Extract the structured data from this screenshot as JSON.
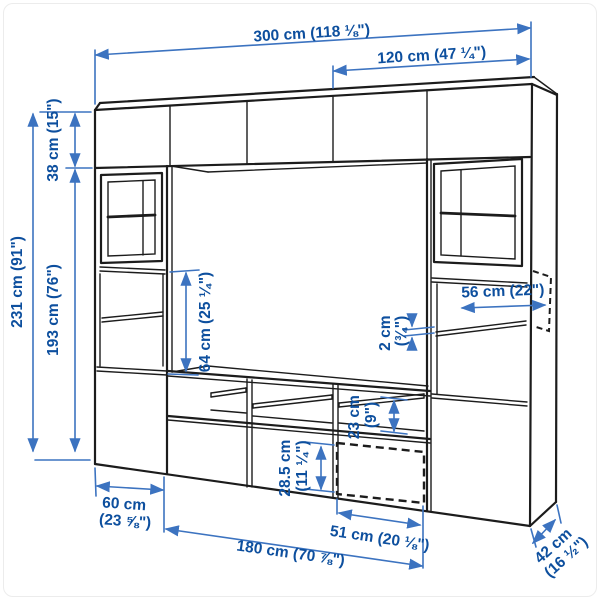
{
  "title": "Wall storage combination dimension diagram",
  "colors": {
    "outline": "#1c1c1c",
    "dimension_line": "#3c73c0",
    "dimension_text": "#0d4f9e",
    "background": "#ffffff"
  },
  "dimensions": {
    "width_total": {
      "label": "300 cm (118 ⅛\")"
    },
    "width_right_section": {
      "label": "120 cm (47 ¼\")"
    },
    "height_total": {
      "label": "231 cm (91\")"
    },
    "height_top_cabinet": {
      "label": "38 cm (15\")"
    },
    "height_tall_cabinet": {
      "label": "193 cm (76\")"
    },
    "height_tv_space": {
      "label": "64 cm (25 ¼\")"
    },
    "shelf_depth": {
      "label": "56 cm (22\")"
    },
    "shelf_thickness": {
      "line1": "2 cm",
      "line2": "(¾\")"
    },
    "compartment_height": {
      "line1": "23 cm",
      "line2": "(9\")"
    },
    "drawer_height": {
      "line1": "28.5 cm",
      "line2": "(11 ¼\")"
    },
    "left_cabinet_width": {
      "line1": "60 cm",
      "line2": "(23 ⅝\")"
    },
    "tv_bench_width": {
      "label": "180 cm (70 ⅞\")"
    },
    "door_width": {
      "label": "51 cm (20 ⅛\")"
    },
    "depth_total": {
      "line1": "42 cm",
      "line2": "(16 ½\")"
    }
  }
}
